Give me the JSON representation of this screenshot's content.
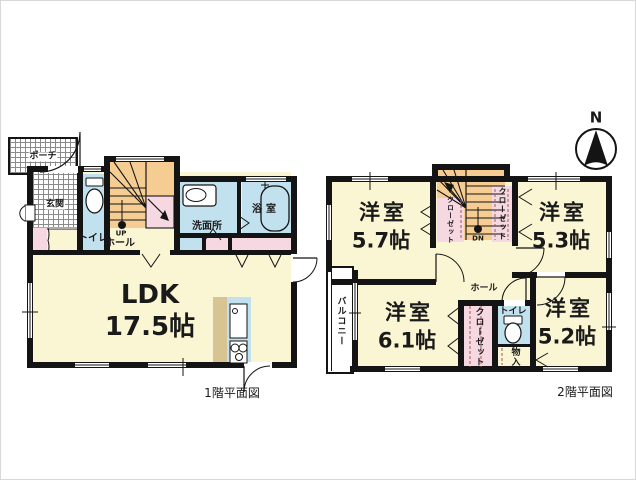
{
  "compass": {
    "north": "N"
  },
  "floor1": {
    "caption": "1階平面図",
    "porch": "ポーチ",
    "entrance": "玄関",
    "toilet": "トイレ",
    "hall": "ホール",
    "stairs": "UP",
    "washroom": "洗面所",
    "bath": "浴室",
    "ldk": "LDK",
    "ldk_size": "17.5帖"
  },
  "floor2": {
    "caption": "2階平面図",
    "bedroom_nw": {
      "name": "洋室",
      "size": "5.7帖"
    },
    "bedroom_ne": {
      "name": "洋室",
      "size": "5.3帖"
    },
    "bedroom_sw": {
      "name": "洋室",
      "size": "6.1帖"
    },
    "bedroom_se": {
      "name": "洋室",
      "size": "5.2帖"
    },
    "closet_nw": "クローゼット",
    "closet_ne": "クローゼット",
    "closet_s": "クローゼット",
    "toilet": "トイレ",
    "storage": "物入",
    "hall": "ホール",
    "balcony": "バルコニー",
    "stairs": "DN"
  },
  "colors": {
    "room_yellow": "#FAF6D3",
    "wet_area_blue": "#C2E1EF",
    "stair_orange": "#F5CD92",
    "closet_pink": "#F5D8E2",
    "wall_black": "#141414",
    "kitchen_counter_tan": "#D8C493"
  }
}
